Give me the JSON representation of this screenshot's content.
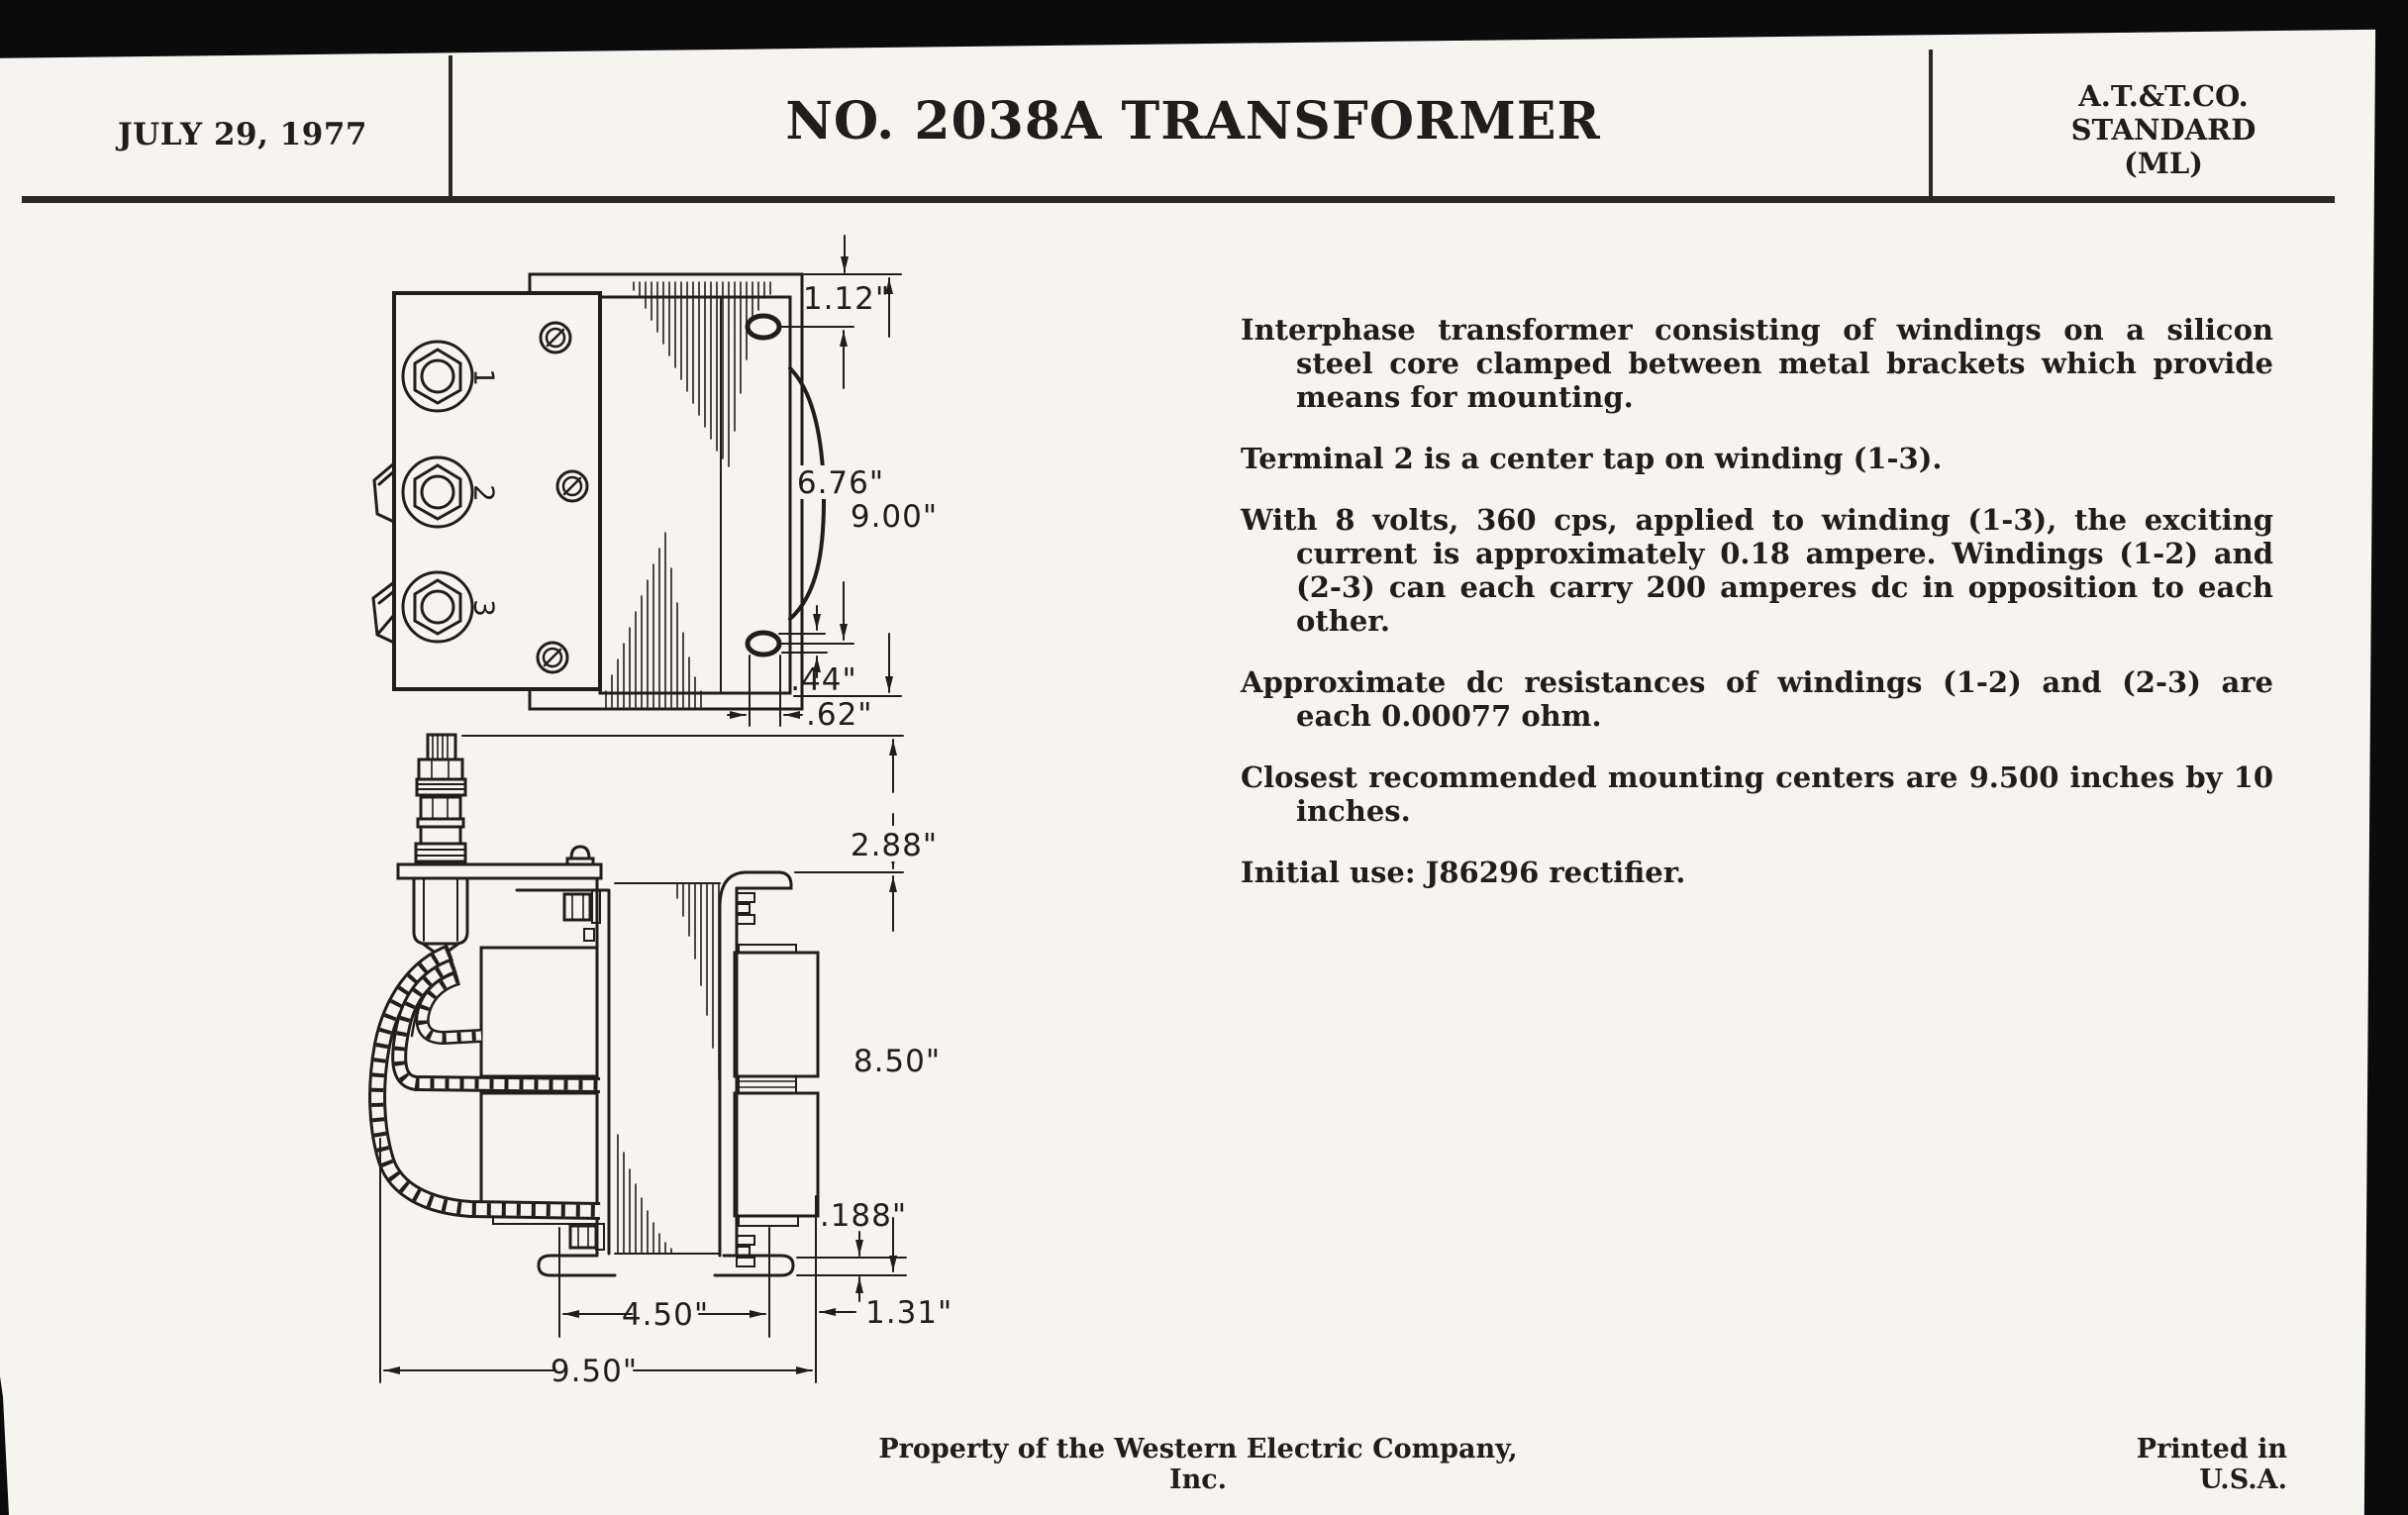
{
  "header": {
    "date": "JULY 29, 1977",
    "title": "NO. 2038A TRANSFORMER",
    "standard_line1": "A.T.&T.CO.",
    "standard_line2": "STANDARD",
    "standard_line3": "(ML)"
  },
  "specs": {
    "paragraphs": [
      "Interphase transformer consisting of windings on a silicon steel core clamped between metal brackets which provide means for mounting.",
      "Terminal 2 is a center tap on winding (1-3).",
      "With 8 volts, 360 cps, applied to winding (1-3), the exciting current is approximately 0.18 ampere.  Windings (1-2) and (2-3) can each carry 200 amperes dc in opposition to each other.",
      "Approximate dc resistances of windings (1-2) and (2-3) are each 0.00077 ohm.",
      "Closest recommended mounting centers are 9.500 inches by 10 inches.",
      "Initial use:  J86296 rectifier."
    ]
  },
  "drawing": {
    "top_view": {
      "dim_slot_offset": "1.12\"",
      "dim_slot_span": "6.76\"",
      "dim_overall_height": "9.00\"",
      "dim_slot_width": ".44\"",
      "dim_slot_inset": ".62\"",
      "terminal_1": "1",
      "terminal_2": "2",
      "terminal_3": "3"
    },
    "side_view": {
      "dim_stud_height": "2.88\"",
      "dim_body_height": "8.50\"",
      "dim_foot_thickness": ".188\"",
      "dim_foot_centers": "4.50\"",
      "dim_overhang": "1.31\"",
      "dim_overall_width": "9.50\""
    }
  },
  "footer": {
    "left": "Property of the Western Electric Company, Inc.",
    "right": "Printed in U.S.A."
  },
  "colors": {
    "paper": "#f6f4ef",
    "ink": "#1f1e1c",
    "scan_border": "#0b0b0b"
  }
}
